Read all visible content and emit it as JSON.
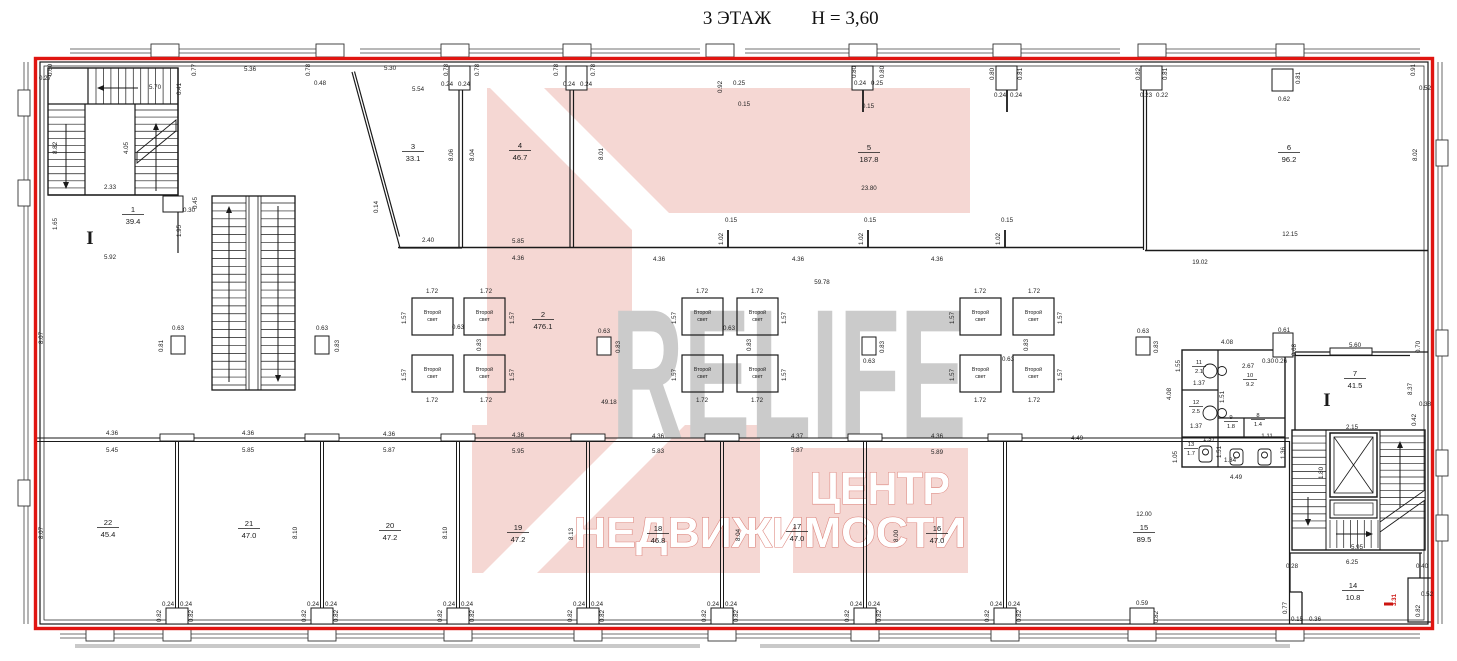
{
  "title": {
    "floor": "3 ЭТАЖ",
    "height": "Н = 3,60"
  },
  "watermark": {
    "brand": "RELIFE",
    "company_line1": "ЦЕНТР",
    "company_line2": "НЕДВИЖИМОСТИ",
    "pink": "#f5d7d3",
    "gray": "#cbcbcb",
    "outline_red": "#e01511"
  },
  "section_marks": [
    {
      "t": "I",
      "x": 90,
      "y": 244
    },
    {
      "t": "I",
      "x": 1327,
      "y": 406
    }
  ],
  "second_light": {
    "line1": "Второй",
    "line2": "свет",
    "cells": [
      {
        "x": 412,
        "y": 298
      },
      {
        "x": 464,
        "y": 298
      },
      {
        "x": 412,
        "y": 355
      },
      {
        "x": 464,
        "y": 355
      },
      {
        "x": 682,
        "y": 298
      },
      {
        "x": 737,
        "y": 298
      },
      {
        "x": 682,
        "y": 355
      },
      {
        "x": 737,
        "y": 355
      },
      {
        "x": 960,
        "y": 298
      },
      {
        "x": 1013,
        "y": 298
      },
      {
        "x": 960,
        "y": 355
      },
      {
        "x": 1013,
        "y": 355
      }
    ]
  },
  "rooms": [
    {
      "n": "1",
      "a": "39.4",
      "x": 133,
      "y": 212
    },
    {
      "n": "2",
      "a": "476.1",
      "x": 543,
      "y": 317
    },
    {
      "n": "3",
      "a": "33.1",
      "x": 413,
      "y": 149
    },
    {
      "n": "4",
      "a": "46.7",
      "x": 520,
      "y": 148
    },
    {
      "n": "5",
      "a": "187.8",
      "x": 869,
      "y": 150
    },
    {
      "n": "6",
      "a": "96.2",
      "x": 1289,
      "y": 150
    },
    {
      "n": "7",
      "a": "41.5",
      "x": 1355,
      "y": 376
    },
    {
      "n": "8",
      "a": "1.4",
      "x": 1258,
      "y": 417,
      "s": 1
    },
    {
      "n": "9",
      "a": "1.8",
      "x": 1231,
      "y": 419,
      "s": 1
    },
    {
      "n": "10",
      "a": "9.2",
      "x": 1250,
      "y": 377,
      "s": 1
    },
    {
      "n": "11",
      "a": "2.1",
      "x": 1199,
      "y": 364,
      "s": 1
    },
    {
      "n": "12",
      "a": "2.5",
      "x": 1196,
      "y": 404,
      "s": 1
    },
    {
      "n": "13",
      "a": "1.7",
      "x": 1191,
      "y": 446,
      "s": 1
    },
    {
      "n": "14",
      "a": "10.8",
      "x": 1353,
      "y": 588
    },
    {
      "n": "15",
      "a": "89.5",
      "x": 1144,
      "y": 530
    },
    {
      "n": "16",
      "a": "47.0",
      "x": 937,
      "y": 531
    },
    {
      "n": "17",
      "a": "47.0",
      "x": 797,
      "y": 529
    },
    {
      "n": "18",
      "a": "46.8",
      "x": 658,
      "y": 531
    },
    {
      "n": "19",
      "a": "47.2",
      "x": 518,
      "y": 530
    },
    {
      "n": "20",
      "a": "47.2",
      "x": 390,
      "y": 528
    },
    {
      "n": "21",
      "a": "47.0",
      "x": 249,
      "y": 526
    },
    {
      "n": "22",
      "a": "45.4",
      "x": 108,
      "y": 525
    }
  ],
  "dims": [
    [
      "0.60",
      52,
      70,
      1
    ],
    [
      "0.27",
      45,
      80,
      0
    ],
    [
      "5.70",
      155,
      89,
      0
    ],
    [
      "0.41",
      181,
      89,
      1
    ],
    [
      "0.77",
      196,
      70,
      1
    ],
    [
      "5.36",
      250,
      71,
      0
    ],
    [
      "0.78",
      310,
      70,
      1
    ],
    [
      "0.48",
      320,
      85,
      0
    ],
    [
      "5.30",
      390,
      70,
      0
    ],
    [
      "5.54",
      418,
      91,
      0
    ],
    [
      "0.78",
      448,
      70,
      1
    ],
    [
      "0.24",
      447,
      86,
      0
    ],
    [
      "0.24",
      464,
      86,
      0
    ],
    [
      "0.78",
      479,
      70,
      1
    ],
    [
      "0.78",
      558,
      70,
      1
    ],
    [
      "0.24",
      569,
      86,
      0
    ],
    [
      "0.24",
      586,
      86,
      0
    ],
    [
      "0.78",
      595,
      70,
      1
    ],
    [
      "0.92",
      722,
      87,
      1
    ],
    [
      "0.25",
      739,
      85,
      0
    ],
    [
      "0.15",
      744,
      106,
      0
    ],
    [
      "0.80",
      856,
      72,
      1
    ],
    [
      "0.24",
      860,
      85,
      0
    ],
    [
      "0.25",
      877,
      85,
      0
    ],
    [
      "0.80",
      884,
      72,
      1
    ],
    [
      "0.15",
      868,
      108,
      0
    ],
    [
      "0.80",
      994,
      74,
      1
    ],
    [
      "0.24",
      1000,
      97,
      0
    ],
    [
      "0.24",
      1016,
      97,
      0
    ],
    [
      "0.81",
      1022,
      74,
      1
    ],
    [
      "0.82",
      1140,
      74,
      1
    ],
    [
      "0.23",
      1146,
      97,
      0
    ],
    [
      "0.22",
      1162,
      97,
      0
    ],
    [
      "0.81",
      1167,
      74,
      1
    ],
    [
      "0.62",
      1284,
      101,
      0
    ],
    [
      "0.81",
      1300,
      78,
      1
    ],
    [
      "0.91",
      1415,
      70,
      1
    ],
    [
      "0.52",
      1425,
      90,
      0
    ],
    [
      "8.82",
      57,
      148,
      1
    ],
    [
      "4.05",
      128,
      148,
      1
    ],
    [
      "2.33",
      110,
      189,
      0
    ],
    [
      "1.65",
      57,
      224,
      1
    ],
    [
      "5.92",
      110,
      259,
      0
    ],
    [
      "0.30",
      189,
      212,
      0
    ],
    [
      "0.45",
      197,
      203,
      1
    ],
    [
      "1.95",
      181,
      231,
      1
    ],
    [
      "8.07",
      43,
      338,
      1
    ],
    [
      "0.63",
      178,
      330,
      0
    ],
    [
      "0.81",
      163,
      346,
      1
    ],
    [
      "0.63",
      322,
      330,
      0
    ],
    [
      "0.83",
      339,
      346,
      1
    ],
    [
      "0.14",
      378,
      207,
      1
    ],
    [
      "2.40",
      428,
      242,
      0
    ],
    [
      "8.06",
      453,
      155,
      1
    ],
    [
      "8.04",
      474,
      155,
      1
    ],
    [
      "8.01",
      603,
      154,
      1
    ],
    [
      "5.85",
      518,
      243,
      0
    ],
    [
      "4.36",
      518,
      260,
      0
    ],
    [
      "23.80",
      869,
      190,
      0
    ],
    [
      "0.15",
      731,
      222,
      0
    ],
    [
      "0.15",
      870,
      222,
      0
    ],
    [
      "0.15",
      1007,
      222,
      0
    ],
    [
      "1.02",
      723,
      239,
      1
    ],
    [
      "1.02",
      863,
      239,
      1
    ],
    [
      "1.02",
      1000,
      239,
      1
    ],
    [
      "4.36",
      659,
      261,
      0
    ],
    [
      "4.36",
      798,
      261,
      0
    ],
    [
      "4.36",
      937,
      261,
      0
    ],
    [
      "59.78",
      822,
      284,
      0
    ],
    [
      "49.18",
      609,
      404,
      0
    ],
    [
      "19.02",
      1200,
      264,
      0
    ],
    [
      "12.15",
      1290,
      236,
      0
    ],
    [
      "8.02",
      1417,
      155,
      1
    ],
    [
      "1.72",
      432,
      293,
      0
    ],
    [
      "1.72",
      486,
      293,
      0
    ],
    [
      "1.72",
      432,
      402,
      0
    ],
    [
      "1.72",
      486,
      402,
      0
    ],
    [
      "1.57",
      406,
      318,
      1
    ],
    [
      "1.57",
      406,
      375,
      1
    ],
    [
      "1.57",
      514,
      318,
      1
    ],
    [
      "1.57",
      514,
      375,
      1
    ],
    [
      "0.63",
      458,
      329,
      0
    ],
    [
      "0.83",
      481,
      345,
      1
    ],
    [
      "0.63",
      604,
      333,
      0
    ],
    [
      "0.83",
      620,
      347,
      1
    ],
    [
      "1.72",
      702,
      293,
      0
    ],
    [
      "1.72",
      757,
      293,
      0
    ],
    [
      "1.72",
      702,
      402,
      0
    ],
    [
      "1.72",
      757,
      402,
      0
    ],
    [
      "1.57",
      676,
      318,
      1
    ],
    [
      "1.57",
      676,
      375,
      1
    ],
    [
      "1.57",
      786,
      318,
      1
    ],
    [
      "1.57",
      786,
      375,
      1
    ],
    [
      "0.63",
      729,
      330,
      0
    ],
    [
      "0.83",
      751,
      345,
      1
    ],
    [
      "0.63",
      869,
      363,
      0
    ],
    [
      "0.83",
      884,
      347,
      1
    ],
    [
      "1.72",
      980,
      293,
      0
    ],
    [
      "1.72",
      1034,
      293,
      0
    ],
    [
      "1.72",
      980,
      402,
      0
    ],
    [
      "1.72",
      1034,
      402,
      0
    ],
    [
      "1.57",
      954,
      318,
      1
    ],
    [
      "1.57",
      954,
      375,
      1
    ],
    [
      "1.57",
      1062,
      318,
      1
    ],
    [
      "1.57",
      1062,
      375,
      1
    ],
    [
      "0.63",
      1008,
      361,
      0
    ],
    [
      "0.83",
      1028,
      345,
      1
    ],
    [
      "0.63",
      1143,
      333,
      0
    ],
    [
      "0.83",
      1158,
      347,
      1
    ],
    [
      "4.08",
      1171,
      394,
      1
    ],
    [
      "4.08",
      1227,
      344,
      0
    ],
    [
      "2.67",
      1248,
      368,
      0
    ],
    [
      "1.55",
      1180,
      366,
      1
    ],
    [
      "1.37",
      1199,
      385,
      0
    ],
    [
      "1.51",
      1224,
      397,
      1
    ],
    [
      "0.30",
      1268,
      363,
      0
    ],
    [
      "0.26",
      1281,
      363,
      0
    ],
    [
      "0.61",
      1284,
      332,
      0
    ],
    [
      "0.68",
      1296,
      350,
      1
    ],
    [
      "1.37",
      1196,
      428,
      0
    ],
    [
      "1.11",
      1267,
      438,
      0
    ],
    [
      "1.37",
      1209,
      441,
      0
    ],
    [
      "1.51",
      1221,
      452,
      1
    ],
    [
      "1.34",
      1230,
      462,
      0
    ],
    [
      "1.36",
      1285,
      453,
      1
    ],
    [
      "1.05",
      1177,
      457,
      1
    ],
    [
      "4.49",
      1236,
      479,
      0
    ],
    [
      "5.60",
      1355,
      347,
      0
    ],
    [
      "0.70",
      1420,
      347,
      1
    ],
    [
      "8.37",
      1412,
      389,
      1
    ],
    [
      "0.38",
      1425,
      406,
      0
    ],
    [
      "0.42",
      1416,
      420,
      1
    ],
    [
      "2.15",
      1352,
      429,
      0
    ],
    [
      "1.80",
      1323,
      473,
      1
    ],
    [
      "5.95",
      1357,
      549,
      0
    ],
    [
      "6.25",
      1352,
      564,
      0
    ],
    [
      "0.28",
      1292,
      568,
      0
    ],
    [
      "0.40",
      1422,
      568,
      0
    ],
    [
      "0.52",
      1427,
      596,
      0
    ],
    [
      "0.82",
      1420,
      611,
      1
    ],
    [
      "0.15",
      1297,
      621,
      0
    ],
    [
      "0.36",
      1315,
      621,
      0
    ],
    [
      "0.77",
      1287,
      608,
      1
    ],
    [
      "3.31",
      1396,
      600,
      1,
      "red"
    ],
    [
      "4.36",
      112,
      435,
      0
    ],
    [
      "5.45",
      112,
      452,
      0
    ],
    [
      "4.36",
      248,
      435,
      0
    ],
    [
      "5.85",
      248,
      452,
      0
    ],
    [
      "4.36",
      389,
      436,
      0
    ],
    [
      "5.87",
      389,
      452,
      0
    ],
    [
      "4.36",
      518,
      437,
      0
    ],
    [
      "5.95",
      518,
      453,
      0
    ],
    [
      "4.36",
      658,
      438,
      0
    ],
    [
      "5.83",
      658,
      453,
      0
    ],
    [
      "4.37",
      797,
      438,
      0
    ],
    [
      "5.87",
      797,
      452,
      0
    ],
    [
      "4.36",
      937,
      438,
      0
    ],
    [
      "5.89",
      937,
      454,
      0
    ],
    [
      "4.49",
      1077,
      440,
      0
    ],
    [
      "12.00",
      1144,
      516,
      0
    ],
    [
      "8.07",
      43,
      533,
      1
    ],
    [
      "8.10",
      297,
      533,
      1
    ],
    [
      "8.10",
      447,
      533,
      1
    ],
    [
      "8.13",
      573,
      534,
      1
    ],
    [
      "8.04",
      740,
      535,
      1
    ],
    [
      "8.00",
      898,
      536,
      1
    ],
    [
      "0.24",
      168,
      606,
      0
    ],
    [
      "0.24",
      186,
      606,
      0
    ],
    [
      "0.82",
      161,
      616,
      1
    ],
    [
      "0.82",
      193,
      616,
      1
    ],
    [
      "0.24",
      313,
      606,
      0
    ],
    [
      "0.24",
      331,
      606,
      0
    ],
    [
      "0.82",
      306,
      616,
      1
    ],
    [
      "0.82",
      338,
      616,
      1
    ],
    [
      "0.24",
      449,
      606,
      0
    ],
    [
      "0.24",
      467,
      606,
      0
    ],
    [
      "0.82",
      442,
      616,
      1
    ],
    [
      "0.82",
      474,
      616,
      1
    ],
    [
      "0.24",
      579,
      606,
      0
    ],
    [
      "0.24",
      597,
      606,
      0
    ],
    [
      "0.82",
      572,
      616,
      1
    ],
    [
      "0.82",
      604,
      616,
      1
    ],
    [
      "0.24",
      713,
      606,
      0
    ],
    [
      "0.24",
      731,
      606,
      0
    ],
    [
      "0.82",
      706,
      616,
      1
    ],
    [
      "0.82",
      738,
      616,
      1
    ],
    [
      "0.24",
      856,
      606,
      0
    ],
    [
      "0.24",
      874,
      606,
      0
    ],
    [
      "0.82",
      849,
      616,
      1
    ],
    [
      "0.82",
      881,
      616,
      1
    ],
    [
      "0.24",
      996,
      606,
      0
    ],
    [
      "0.24",
      1014,
      606,
      0
    ],
    [
      "0.82",
      989,
      616,
      1
    ],
    [
      "0.82",
      1021,
      616,
      1
    ],
    [
      "0.59",
      1142,
      605,
      0
    ],
    [
      "0.82",
      1158,
      617,
      1
    ]
  ]
}
